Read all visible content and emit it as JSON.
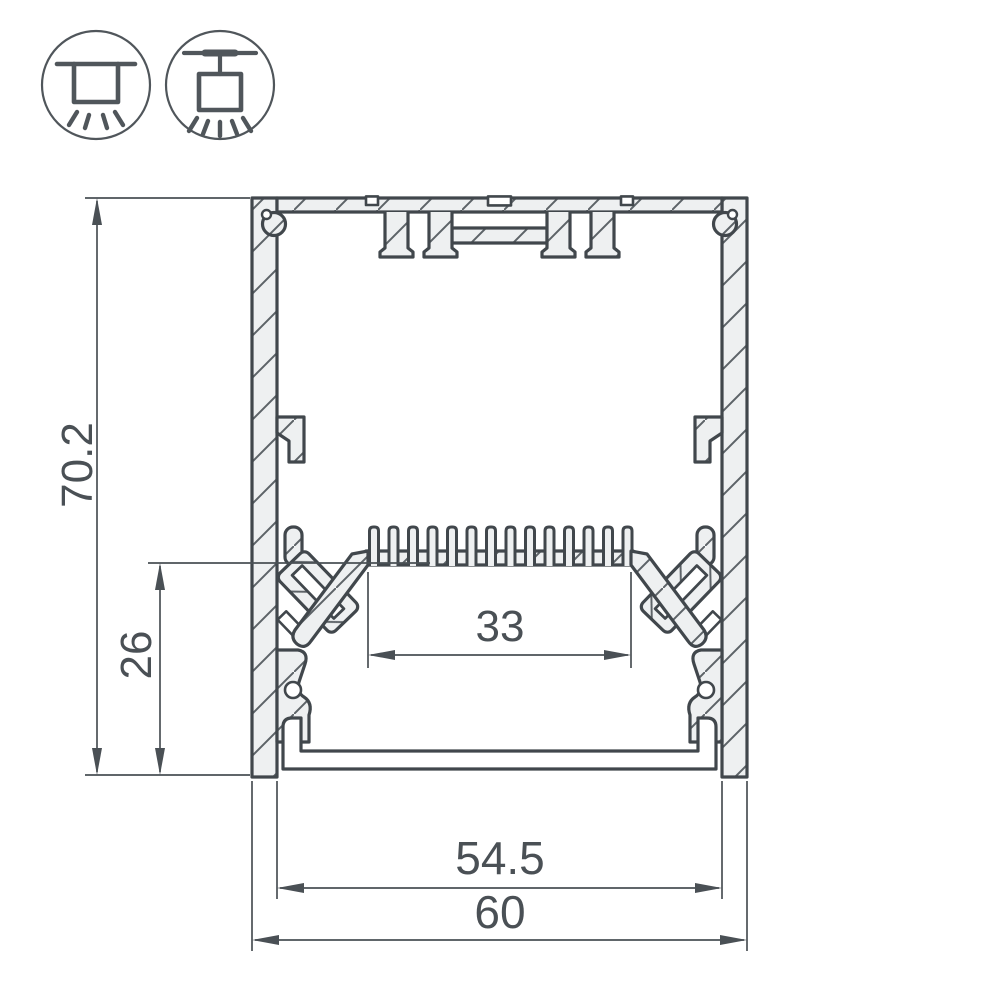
{
  "drawing": {
    "dimensions": {
      "overall_height_mm": "70.2",
      "chamber_height_mm": "26",
      "led_shelf_width_mm": "33",
      "inner_width_mm": "54.5",
      "overall_width_mm": "60"
    },
    "icons": [
      {
        "name": "surface-mount-light-icon"
      },
      {
        "name": "pendant-mount-light-icon"
      }
    ],
    "colors": {
      "line": "#41474c",
      "metal_fill": "#eef0f1",
      "hatch_line": "#5d6368",
      "dimension": "#4a5055",
      "background": "#ffffff"
    }
  }
}
